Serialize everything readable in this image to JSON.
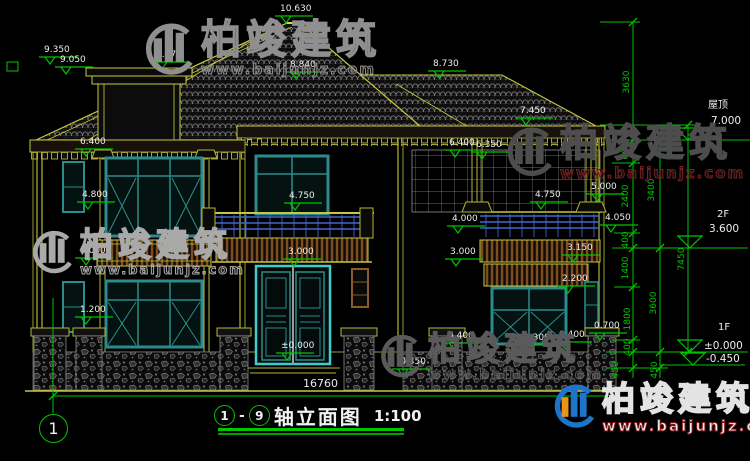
{
  "colors": {
    "background": "#000000",
    "cad_yellow": "#b6b636",
    "cad_green": "#00c400",
    "door_cyan": "#40cccc",
    "window_teal": "#2e8b8b",
    "railing_blue": "#4466cc",
    "fascia_brown": "#8a5a28",
    "roof_gray": "#787878",
    "text_white": "#ededed",
    "watermark_gray": "#8f8f8f",
    "watermark_red": "#8b1a1a",
    "logo_blue": "#1e74c8",
    "logo_orange": "#e8941a"
  },
  "levels": [
    {
      "text": "10.630",
      "x": 280,
      "y": 5
    },
    {
      "text": "9.350",
      "x": 44,
      "y": 46
    },
    {
      "text": "9.050",
      "x": 60,
      "y": 56
    },
    {
      "text": "9.170",
      "x": 156,
      "y": 51
    },
    {
      "text": "8.840",
      "x": 290,
      "y": 61
    },
    {
      "text": "8.730",
      "x": 433,
      "y": 60
    },
    {
      "text": "7.450",
      "x": 520,
      "y": 107
    },
    {
      "text": "6.400",
      "x": 80,
      "y": 138
    },
    {
      "text": "6.400",
      "x": 449,
      "y": 139
    },
    {
      "text": "6.350",
      "x": 476,
      "y": 141
    },
    {
      "text": "4.800",
      "x": 82,
      "y": 191
    },
    {
      "text": "4.750",
      "x": 289,
      "y": 192
    },
    {
      "text": "4.750",
      "x": 535,
      "y": 191
    },
    {
      "text": "5.000",
      "x": 591,
      "y": 183
    },
    {
      "text": "4.050",
      "x": 605,
      "y": 214
    },
    {
      "text": "4.000",
      "x": 452,
      "y": 215
    },
    {
      "text": "3.150",
      "x": 567,
      "y": 244
    },
    {
      "text": "3.000",
      "x": 80,
      "y": 247
    },
    {
      "text": "3.000",
      "x": 288,
      "y": 248
    },
    {
      "text": "3.000",
      "x": 450,
      "y": 248
    },
    {
      "text": "2.200",
      "x": 562,
      "y": 275
    },
    {
      "text": "1.200",
      "x": 80,
      "y": 306
    },
    {
      "text": "0.700",
      "x": 594,
      "y": 322
    },
    {
      "text": "0.400",
      "x": 448,
      "y": 332
    },
    {
      "text": "0.300",
      "x": 524,
      "y": 334
    },
    {
      "text": "0.400",
      "x": 559,
      "y": 331
    },
    {
      "text": "±0.000",
      "x": 281,
      "y": 342
    },
    {
      "text": "-0.450",
      "x": 397,
      "y": 358
    }
  ],
  "dims": [
    {
      "text": "3630",
      "x": 627,
      "y": 82
    },
    {
      "text": "600",
      "x": 626,
      "y": 151
    },
    {
      "text": "2400",
      "x": 626,
      "y": 196
    },
    {
      "text": "400",
      "x": 626,
      "y": 240
    },
    {
      "text": "1400",
      "x": 626,
      "y": 268
    },
    {
      "text": "1800",
      "x": 628,
      "y": 319
    },
    {
      "text": "400",
      "x": 628,
      "y": 347
    },
    {
      "text": "450",
      "x": 616,
      "y": 370
    },
    {
      "text": "3400",
      "x": 652,
      "y": 190
    },
    {
      "text": "3600",
      "x": 654,
      "y": 303
    },
    {
      "text": "450",
      "x": 655,
      "y": 370
    },
    {
      "text": "7450",
      "x": 682,
      "y": 259
    }
  ],
  "side_labels": [
    {
      "text": "屋顶",
      "x": 708,
      "y": 96,
      "size": 10
    },
    {
      "text": "7.000",
      "x": 711,
      "y": 115,
      "size": 10.5
    },
    {
      "text": "2F",
      "x": 717,
      "y": 209,
      "size": 10
    },
    {
      "text": "3.600",
      "x": 709,
      "y": 223,
      "size": 10.5
    },
    {
      "text": "1F",
      "x": 718,
      "y": 322,
      "size": 10
    },
    {
      "text": "±0.000",
      "x": 704,
      "y": 340,
      "size": 10.5
    },
    {
      "text": "-0.450",
      "x": 706,
      "y": 353,
      "size": 10.5
    }
  ],
  "bottom_dim": {
    "text": "16760"
  },
  "axis_bubble": {
    "label": "1"
  },
  "title_block": {
    "from": "1",
    "separator": "-",
    "to": "9",
    "title": "轴立面图",
    "scale": "1:100"
  },
  "watermarks": [
    {
      "brand": "柏竣建筑",
      "url": "www.baijunjz.com",
      "variant": "gray",
      "x": 140,
      "y": 20,
      "brand_size": 40,
      "url_size": 14
    },
    {
      "brand": "柏竣建筑",
      "url": "www.baijunjz.com",
      "variant": "light",
      "x": 28,
      "y": 228,
      "brand_size": 33,
      "url_size": 13
    },
    {
      "brand": "柏竣建筑",
      "url": "www.baijunjz.com",
      "variant": "dark",
      "x": 502,
      "y": 124,
      "brand_size": 38,
      "url_size": 15
    },
    {
      "brand": "柏竣建筑",
      "url": "www.baijunjz.com",
      "variant": "dim",
      "x": 376,
      "y": 332,
      "brand_size": 33,
      "url_size": 14
    },
    {
      "brand": "柏竣建筑",
      "url": "www.baijunjz.com",
      "variant": "logo",
      "x": 550,
      "y": 382,
      "brand_size": 33,
      "url_size": 15
    }
  ]
}
